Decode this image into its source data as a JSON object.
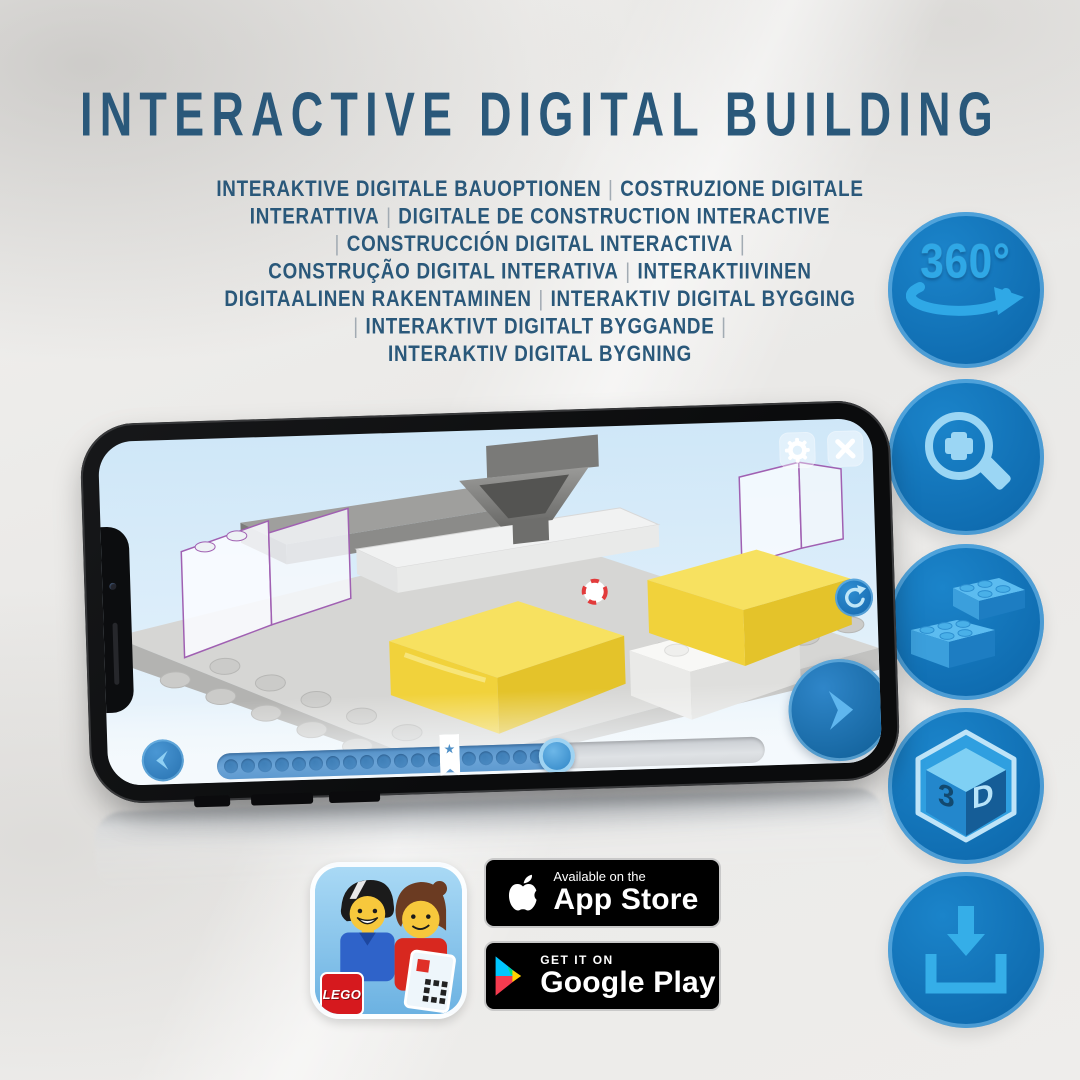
{
  "header": {
    "title": "INTERACTIVE DIGITAL BUILDING"
  },
  "subtitle": {
    "lines": [
      "INTERAKTIVE DIGITALE BAUOPTIONEN | COSTRUZIONE DIGITALE",
      "INTERATTIVA | DIGITALE DE CONSTRUCTION INTERACTIVE",
      "| CONSTRUCCIÓN DIGITAL INTERACTIVA |",
      "CONSTRUÇÃO DIGITAL INTERATIVA | INTERAKTIIVINEN",
      "DIGITAALINEN RAKENTAMINEN | INTERAKTIV DIGITAL BYGGING",
      "| INTERAKTIVT DIGITALT BYGGANDE |",
      "INTERAKTIV DIGITAL BYGNING"
    ]
  },
  "feature_icons": [
    {
      "name": "360-rotation-icon",
      "label": "360°"
    },
    {
      "name": "zoom-in-icon"
    },
    {
      "name": "lego-bricks-icon"
    },
    {
      "name": "3d-cube-icon",
      "text_3": "3",
      "text_d": "D"
    },
    {
      "name": "download-icon"
    }
  ],
  "phone_app": {
    "progress": {
      "total_dots": 19,
      "fill_percent": 62,
      "bookmark_percent": 42.5,
      "bookmark_star": "★"
    },
    "icons": [
      "settings-gear-icon",
      "close-icon",
      "rotate-model-icon",
      "previous-step-icon",
      "next-step-icon"
    ]
  },
  "store_badges": {
    "lego_icon_text": "LEGO",
    "app_store": {
      "top_line": "Available on the",
      "bottom_line": "App Store"
    },
    "google_play": {
      "top_line": "GET IT ON",
      "bottom_line": "Google Play"
    }
  },
  "colors": {
    "headline_blue": "#2a587a",
    "circle_blue": "#0f6cb0",
    "icon_light_blue": "#35aee8",
    "screen_sky": "#cfe7f8",
    "highlight_yellow": "#f1d23b",
    "outline_purple": "#a060b2",
    "badge_black": "#000000"
  }
}
